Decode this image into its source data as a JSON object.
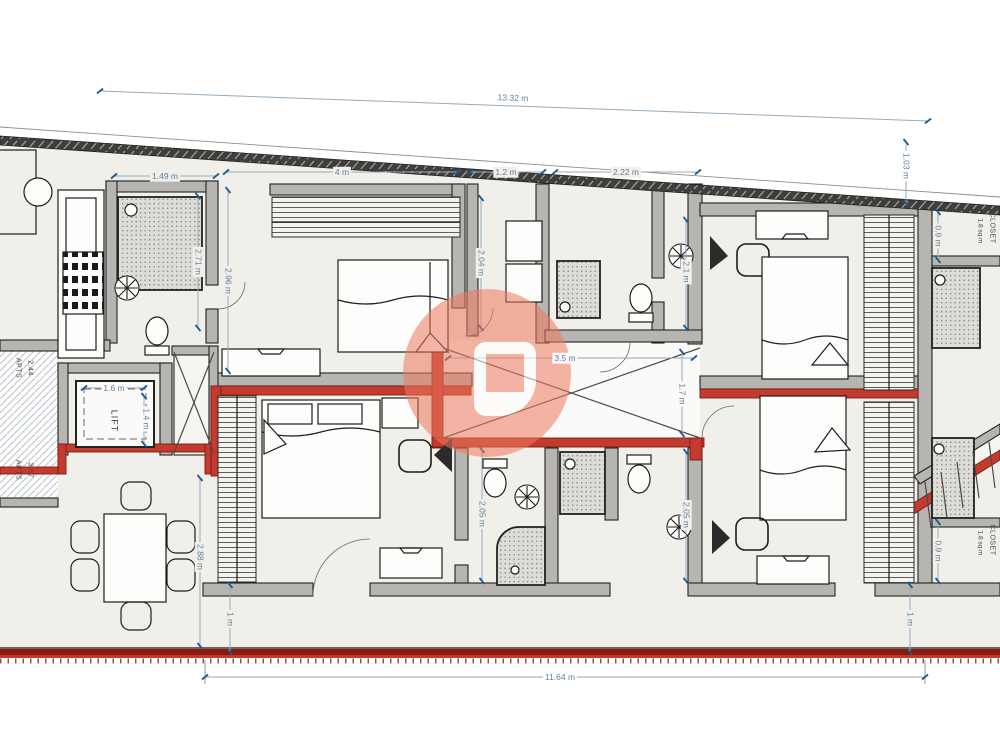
{
  "plan": {
    "wall_color": "#b7b5b1",
    "new_wall_color": "#c23b2e",
    "boundary_color": "#8a1a10",
    "dim_color": "#5f7f9c",
    "watermark_color": "#ee7a5e"
  },
  "dims": {
    "total_top": "13.32 m",
    "total_bottom": "11.64 m",
    "bath1_w": "1.49 m",
    "bed1_w": "4 m",
    "closet1_w": "1.2 m",
    "bath2_w": "2.22 m",
    "right_top": "1.03 m",
    "closet_top_depth": "0.9 m",
    "bath1_h": "2.71 m",
    "bed1_h": "2.96 m",
    "bath2_h": "2.04 m",
    "bath_tr_h": "2.1 m",
    "lift_w": "1.6 m",
    "lift_d": "1.4 m",
    "void_w": "3.5 m",
    "void_h": "1.7 m",
    "dining_h": "2.88 m",
    "left_1m": "1 m",
    "bath3_h": "2.05 m",
    "bath4_h": "2.05 m",
    "closet_bottom_depth": "0.9 m",
    "right_1m": "1 m"
  },
  "rooms": {
    "lift": "LIFT",
    "closet_top": "CLOSET",
    "closet_top_area": "1.8 sq.m",
    "closet_bottom": "CLOSET",
    "closet_bottom_area": "1.8 sq.m",
    "apts_upper": "APTS",
    "apts_upper_value": "2.44",
    "apts_lower": "APTS",
    "apts_lower_value": "3.57"
  }
}
